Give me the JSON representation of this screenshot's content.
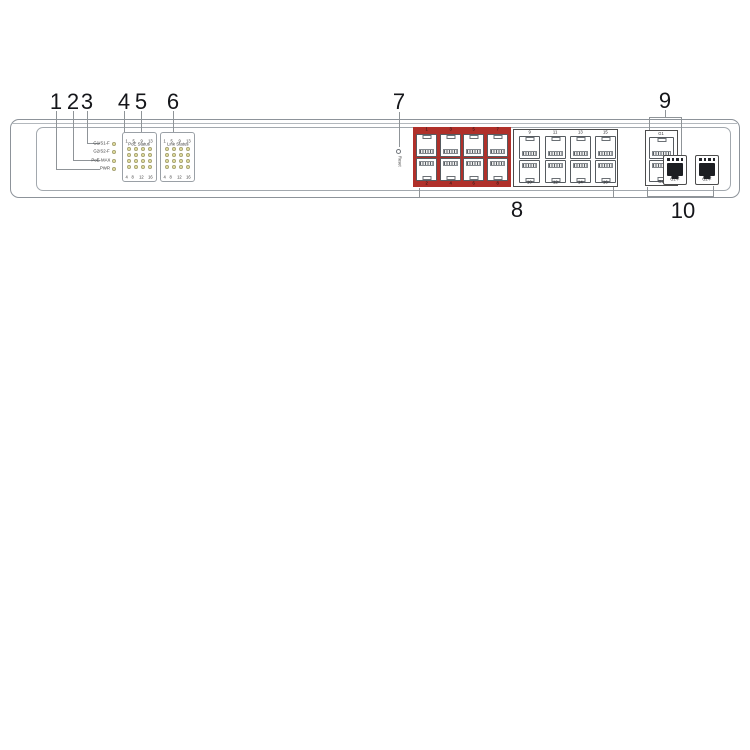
{
  "callouts": {
    "c1": "1",
    "c2": "2",
    "c3": "3",
    "c4": "4",
    "c5": "5",
    "c6": "6",
    "c7": "7",
    "c8": "8",
    "c9": "9",
    "c10": "10"
  },
  "led_panel": {
    "row_labels": [
      "G1/S1-F",
      "G2/S2-F",
      "PoE-MAX",
      "PWR"
    ],
    "blocks": [
      {
        "title": "PoE Status",
        "top_numbers": [
          "1",
          "5",
          "9",
          "13"
        ],
        "bottom_numbers": [
          "4",
          "8",
          "12",
          "16"
        ]
      },
      {
        "title": "Link Status",
        "top_numbers": [
          "1",
          "5",
          "9",
          "13"
        ],
        "bottom_numbers": [
          "4",
          "8",
          "12",
          "16"
        ]
      }
    ]
  },
  "reset_label": "Reset",
  "port_groups": [
    {
      "top_numbers": [
        "1",
        "3",
        "5",
        "7"
      ],
      "bottom_numbers": [
        "2",
        "4",
        "6",
        "8"
      ]
    },
    {
      "top_numbers": [
        "9",
        "11",
        "13",
        "15"
      ],
      "bottom_numbers": [
        "10",
        "12",
        "14",
        "16"
      ]
    }
  ],
  "uplink": {
    "rj45_labels": [
      "G1",
      "G2"
    ],
    "sfp_labels": [
      "G1-F",
      "G2-F"
    ]
  },
  "colors": {
    "highlight_red": "#b0302a",
    "led_fill": "#ece9a4"
  }
}
